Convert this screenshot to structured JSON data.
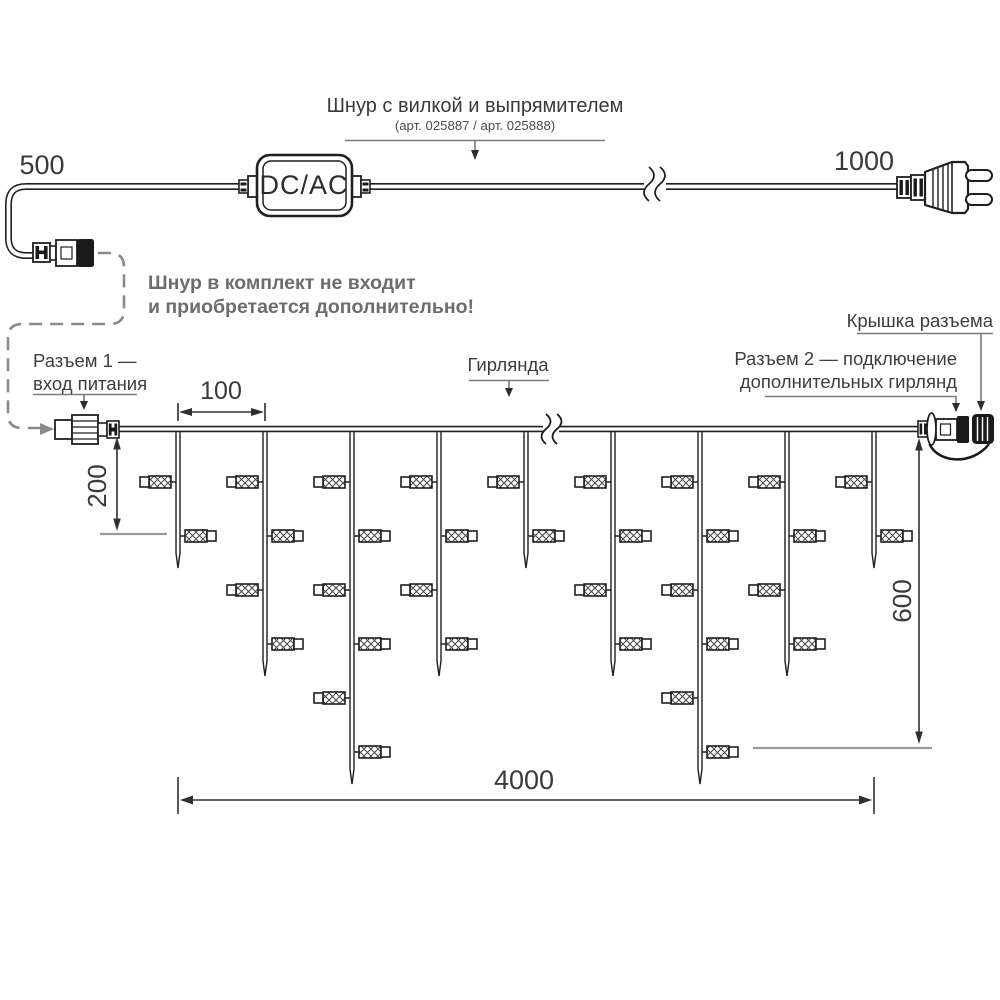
{
  "header": {
    "cord_label": "Шнур с вилкой и выпрямителем",
    "cord_articles": "(арт. 025887 / арт. 025888)",
    "converter_label": "DC/AC"
  },
  "notes": {
    "not_included_line1": "Шнур в комплект не входит",
    "not_included_line2": "и приобретается дополнительно!"
  },
  "callouts": {
    "connector1_line1": "Разъем 1 —",
    "connector1_line2": "вход питания",
    "garland": "Гирлянда",
    "connector2_line1": "Разъем 2 — подключение",
    "connector2_line2": "дополнительных гирлянд",
    "cap": "Крышка разъема"
  },
  "dimensions": {
    "cord_left": "500",
    "cord_right": "1000",
    "drop_spacing": "100",
    "short_drop": "200",
    "long_drop": "600",
    "total_length": "4000"
  },
  "colors": {
    "line": "#1f1f1f",
    "dim": "#2f2f2f",
    "leader": "#7a7a7a",
    "dash": "#8a8a8a",
    "extension": "#9a9a9a",
    "text": "#3d3d3d",
    "note": "#6d6d6d",
    "black_fill": "#1a1a1a",
    "white": "#ffffff"
  },
  "garland": {
    "wire_y": 429,
    "drop_positions_x": [
      178,
      265,
      352,
      439,
      526,
      613,
      700,
      787,
      874
    ],
    "drop_pattern": [
      "short",
      "medium",
      "long",
      "medium",
      "short",
      "medium",
      "long",
      "medium",
      "short"
    ],
    "lamp_rows_y": [
      482,
      536,
      590,
      644,
      698,
      752
    ],
    "tip_y": {
      "short": 568,
      "medium": 676,
      "long": 784
    },
    "lamps_per": {
      "short": 2,
      "medium": 4,
      "long": 6
    }
  }
}
